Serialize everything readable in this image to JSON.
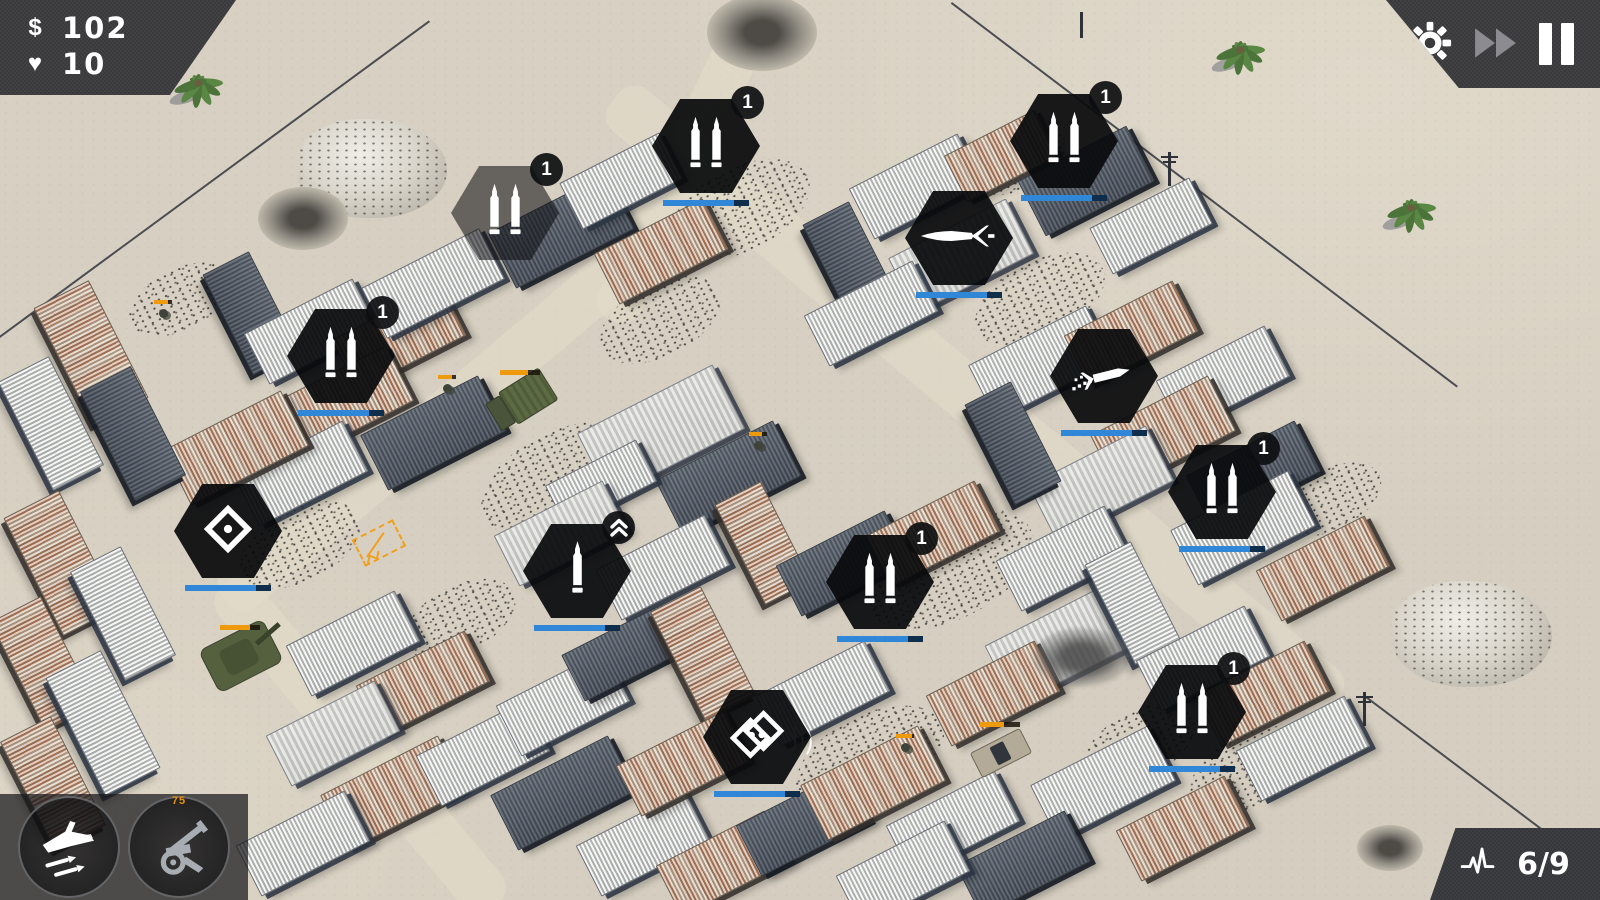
{
  "hud": {
    "money_symbol": "$",
    "money": "102",
    "lives_icon": "♥",
    "lives": "10",
    "wave": "6/9",
    "abilities": [
      {
        "name": "airstrike"
      },
      {
        "name": "artillery",
        "cost": "75"
      }
    ],
    "controls": [
      "settings",
      "fast-forward",
      "pause"
    ]
  },
  "colors": {
    "panel": "#3a3a3c",
    "tower_bar": "#3087d8",
    "enemy_hp": "#ef9a0d",
    "sand": "#d8d1c3",
    "accent_orange": "#f0a01c"
  },
  "map": {
    "towers": [
      {
        "x": 505,
        "y": 213,
        "icon": "double-bullet",
        "badge": "1",
        "bar": false,
        "preview": true
      },
      {
        "x": 706,
        "y": 146,
        "icon": "double-bullet",
        "badge": "1",
        "bar": true
      },
      {
        "x": 1064,
        "y": 141,
        "icon": "double-bullet",
        "badge": "1",
        "bar": true
      },
      {
        "x": 959,
        "y": 238,
        "icon": "rocket",
        "badge": null,
        "bar": true
      },
      {
        "x": 341,
        "y": 356,
        "icon": "double-bullet",
        "badge": "1",
        "bar": true
      },
      {
        "x": 1104,
        "y": 376,
        "icon": "missile-trail",
        "badge": null,
        "bar": true
      },
      {
        "x": 1222,
        "y": 492,
        "icon": "double-bullet",
        "badge": "1",
        "bar": true
      },
      {
        "x": 228,
        "y": 531,
        "icon": "diamond",
        "badge": null,
        "bar": true
      },
      {
        "x": 577,
        "y": 571,
        "icon": "single-bullet",
        "badge": "upgrade",
        "bar": true
      },
      {
        "x": 880,
        "y": 582,
        "icon": "double-bullet",
        "badge": "1",
        "bar": true
      },
      {
        "x": 757,
        "y": 737,
        "icon": "double-diamond",
        "badge": null,
        "bar": true
      },
      {
        "x": 1192,
        "y": 712,
        "icon": "double-bullet",
        "badge": "1",
        "bar": true
      }
    ],
    "buildings": [
      [
        560,
        230,
        130,
        60,
        -27,
        "dark"
      ],
      [
        620,
        180,
        110,
        50,
        -27,
        "light"
      ],
      [
        660,
        250,
        120,
        55,
        -27,
        "rust"
      ],
      [
        915,
        185,
        120,
        55,
        -27,
        "light"
      ],
      [
        1000,
        155,
        100,
        50,
        -27,
        "rust"
      ],
      [
        1085,
        180,
        120,
        60,
        -27,
        "dark"
      ],
      [
        1150,
        225,
        110,
        50,
        -27,
        "light"
      ],
      [
        850,
        262,
        110,
        50,
        63,
        "dark"
      ],
      [
        960,
        255,
        130,
        60,
        -27,
        "tarp"
      ],
      [
        870,
        312,
        120,
        55,
        -27,
        "light"
      ],
      [
        250,
        312,
        110,
        50,
        63,
        "dark"
      ],
      [
        310,
        330,
        120,
        55,
        -27,
        "light"
      ],
      [
        398,
        336,
        120,
        55,
        -27,
        "rust"
      ],
      [
        432,
        282,
        130,
        55,
        -27,
        "light"
      ],
      [
        340,
        402,
        130,
        60,
        -27,
        "rust"
      ],
      [
        432,
        432,
        130,
        60,
        -27,
        "dark"
      ],
      [
        300,
        472,
        120,
        55,
        -27,
        "light"
      ],
      [
        235,
        447,
        130,
        60,
        -27,
        "rust"
      ],
      [
        90,
        352,
        130,
        60,
        63,
        "rust"
      ],
      [
        50,
        422,
        120,
        55,
        63,
        "light"
      ],
      [
        132,
        432,
        120,
        55,
        63,
        "dark"
      ],
      [
        660,
        430,
        150,
        70,
        -27,
        "tarp"
      ],
      [
        727,
        477,
        130,
        60,
        -27,
        "dark"
      ],
      [
        600,
        482,
        100,
        45,
        -27,
        "light"
      ],
      [
        560,
        532,
        120,
        55,
        -27,
        "tarp"
      ],
      [
        662,
        566,
        120,
        55,
        -27,
        "light"
      ],
      [
        762,
        542,
        110,
        50,
        63,
        "rust"
      ],
      [
        842,
        562,
        120,
        55,
        -27,
        "dark"
      ],
      [
        932,
        532,
        120,
        55,
        -27,
        "rust"
      ],
      [
        1040,
        362,
        130,
        60,
        -27,
        "light"
      ],
      [
        1130,
        332,
        120,
        55,
        -27,
        "rust"
      ],
      [
        1222,
        377,
        120,
        55,
        -27,
        "light"
      ],
      [
        1162,
        432,
        130,
        60,
        -27,
        "rust"
      ],
      [
        1252,
        472,
        120,
        55,
        -27,
        "dark"
      ],
      [
        1242,
        527,
        130,
        60,
        -27,
        "light"
      ],
      [
        1322,
        567,
        120,
        55,
        -27,
        "rust"
      ],
      [
        1100,
        482,
        130,
        60,
        -27,
        "tarp"
      ],
      [
        1012,
        442,
        110,
        50,
        63,
        "dark"
      ],
      [
        1062,
        557,
        120,
        55,
        -27,
        "light"
      ],
      [
        60,
        562,
        130,
        60,
        63,
        "rust"
      ],
      [
        122,
        612,
        120,
        55,
        63,
        "light"
      ],
      [
        42,
        662,
        120,
        55,
        63,
        "rust"
      ],
      [
        102,
        722,
        130,
        60,
        63,
        "light"
      ],
      [
        52,
        782,
        120,
        55,
        63,
        "rust"
      ],
      [
        352,
        642,
        120,
        55,
        -27,
        "light"
      ],
      [
        422,
        682,
        120,
        55,
        -27,
        "rust"
      ],
      [
        332,
        732,
        120,
        55,
        -27,
        "tarp"
      ],
      [
        392,
        792,
        130,
        60,
        -27,
        "rust"
      ],
      [
        482,
        752,
        120,
        55,
        -27,
        "light"
      ],
      [
        302,
        842,
        120,
        55,
        -27,
        "light"
      ],
      [
        562,
        702,
        120,
        55,
        -27,
        "light"
      ],
      [
        622,
        652,
        110,
        50,
        -27,
        "dark"
      ],
      [
        702,
        652,
        120,
        55,
        63,
        "rust"
      ],
      [
        562,
        792,
        130,
        60,
        -27,
        "dark"
      ],
      [
        642,
        842,
        120,
        55,
        -27,
        "light"
      ],
      [
        722,
        862,
        120,
        55,
        -27,
        "rust"
      ],
      [
        802,
        822,
        120,
        55,
        -27,
        "dark"
      ],
      [
        872,
        782,
        130,
        60,
        -27,
        "rust"
      ],
      [
        952,
        822,
        120,
        55,
        -27,
        "light"
      ],
      [
        682,
        762,
        120,
        55,
        -27,
        "rust"
      ],
      [
        822,
        692,
        120,
        55,
        -27,
        "light"
      ],
      [
        1062,
        642,
        140,
        65,
        -27,
        "tarp"
      ],
      [
        992,
        692,
        120,
        55,
        -27,
        "rust"
      ],
      [
        1132,
        602,
        110,
        50,
        63,
        "light"
      ],
      [
        1202,
        657,
        120,
        55,
        -27,
        "light"
      ],
      [
        1262,
        692,
        120,
        55,
        -27,
        "rust"
      ],
      [
        1302,
        747,
        120,
        55,
        -27,
        "light"
      ],
      [
        1102,
        782,
        130,
        60,
        -27,
        "light"
      ],
      [
        1182,
        827,
        120,
        55,
        -27,
        "rust"
      ],
      [
        1022,
        862,
        120,
        55,
        -27,
        "dark"
      ],
      [
        902,
        872,
        120,
        55,
        -27,
        "light"
      ]
    ],
    "fences": [
      [
        430,
        22,
        0,
        338
      ],
      [
        952,
        2,
        1458,
        386
      ],
      [
        1365,
        695,
        1600,
        872
      ]
    ],
    "roads": [
      {
        "x": 975,
        "y": 400,
        "len": 940,
        "w": 54,
        "rot": 40
      },
      {
        "x": 478,
        "y": 388,
        "len": 660,
        "w": 50,
        "rot": 140
      },
      {
        "x": 700,
        "y": 130,
        "len": 420,
        "w": 46,
        "rot": 115
      },
      {
        "x": 360,
        "y": 745,
        "len": 420,
        "w": 50,
        "rot": 50
      }
    ],
    "decorations": [
      {
        "type": "palm",
        "x": 195,
        "y": 88
      },
      {
        "type": "palm",
        "x": 1237,
        "y": 55
      },
      {
        "type": "palm",
        "x": 1408,
        "y": 213
      },
      {
        "type": "rocks",
        "x": 372,
        "y": 168,
        "w": 150
      },
      {
        "type": "rocks",
        "x": 1472,
        "y": 634,
        "w": 160
      },
      {
        "type": "junk",
        "x": 483,
        "y": 88,
        "w": 140
      },
      {
        "type": "crater",
        "x": 762,
        "y": 32,
        "w": 110
      },
      {
        "type": "crater",
        "x": 303,
        "y": 218,
        "w": 90
      },
      {
        "type": "crater",
        "x": 1390,
        "y": 848,
        "w": 66
      },
      {
        "type": "smoke",
        "x": 1082,
        "y": 657,
        "w": 96
      },
      {
        "type": "debris",
        "x": 560,
        "y": 480,
        "w": 170
      },
      {
        "type": "debris",
        "x": 740,
        "y": 210,
        "w": 150
      },
      {
        "type": "debris",
        "x": 950,
        "y": 570,
        "w": 180
      },
      {
        "type": "debris",
        "x": 1040,
        "y": 300,
        "w": 140
      },
      {
        "type": "debris",
        "x": 870,
        "y": 760,
        "w": 160
      },
      {
        "type": "debris",
        "x": 1250,
        "y": 770,
        "w": 130
      },
      {
        "type": "debris",
        "x": 300,
        "y": 545,
        "w": 130
      },
      {
        "type": "debris",
        "x": 660,
        "y": 320,
        "w": 130
      },
      {
        "type": "debris",
        "x": 1330,
        "y": 500,
        "w": 110
      },
      {
        "type": "debris",
        "x": 180,
        "y": 300,
        "w": 110
      },
      {
        "type": "debris",
        "x": 1020,
        "y": 162,
        "w": 100
      },
      {
        "type": "debris",
        "x": 460,
        "y": 620,
        "w": 120
      },
      {
        "type": "debris",
        "x": 1140,
        "y": 745,
        "w": 120
      },
      {
        "type": "pole",
        "x": 1080,
        "y": 12
      },
      {
        "type": "utility-pole",
        "x": 1168,
        "y": 152
      },
      {
        "type": "utility-pole",
        "x": 1363,
        "y": 692
      },
      {
        "type": "sound-waves",
        "x": 800,
        "y": 737
      },
      {
        "type": "construction",
        "x": 380,
        "y": 545
      }
    ],
    "units": [
      {
        "type": "tank",
        "x": 240,
        "y": 655,
        "rot": -27,
        "hp": 0.75
      },
      {
        "type": "truck",
        "x": 520,
        "y": 400,
        "rot": -32,
        "hp": 0.7
      },
      {
        "type": "pickup",
        "x": 1000,
        "y": 752,
        "rot": -27,
        "hp": 0.6
      },
      {
        "type": "soldier",
        "x": 447,
        "y": 388,
        "hp": 0.8
      },
      {
        "type": "soldier",
        "x": 758,
        "y": 445,
        "hp": 0.7
      },
      {
        "type": "soldier",
        "x": 905,
        "y": 747,
        "hp": 0.9
      },
      {
        "type": "soldier",
        "x": 163,
        "y": 313,
        "hp": 0.8
      }
    ]
  }
}
